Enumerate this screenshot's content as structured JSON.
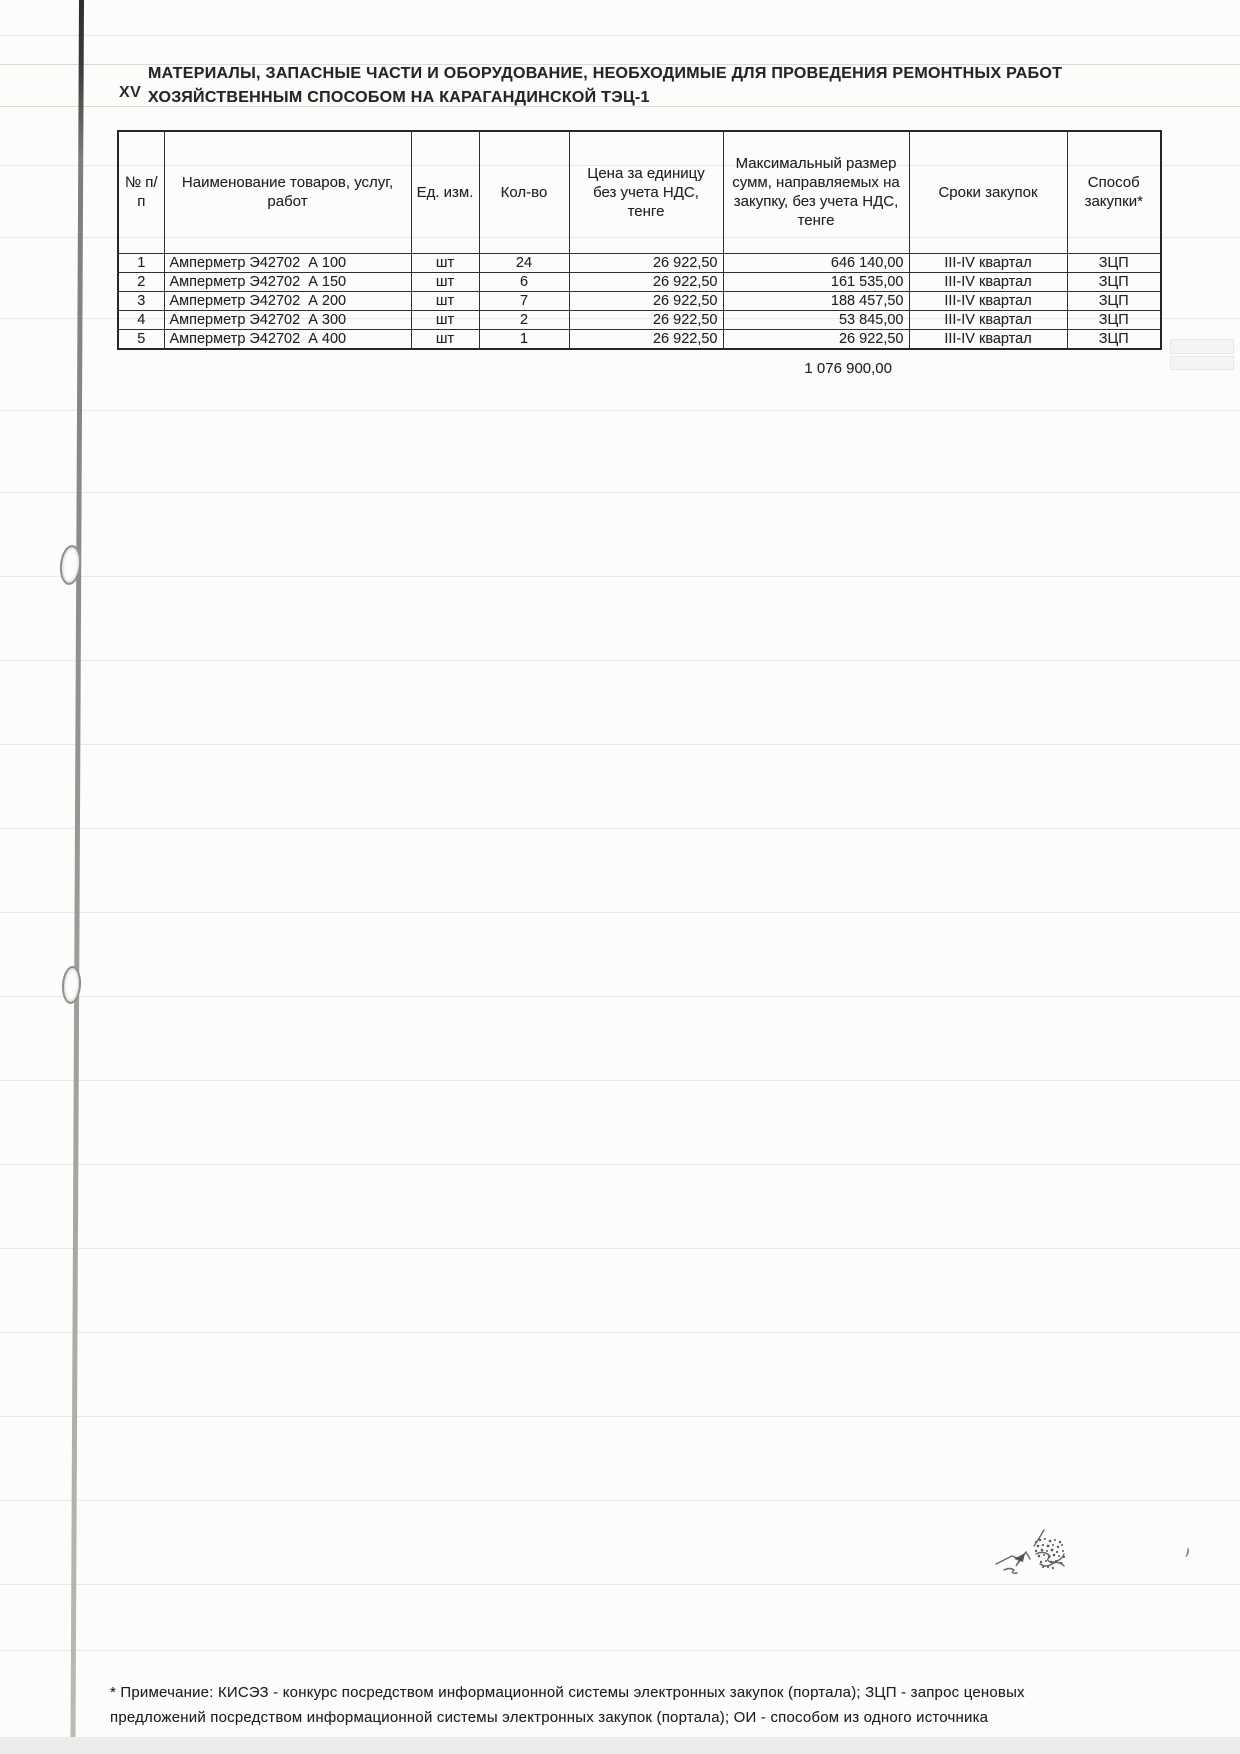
{
  "page": {
    "section_number": "XV",
    "title_line1": "МАТЕРИАЛЫ, ЗАПАСНЫЕ ЧАСТИ И ОБОРУДОВАНИЕ, НЕОБХОДИМЫЕ ДЛЯ ПРОВЕДЕНИЯ РЕМОНТНЫХ РАБОТ",
    "title_line2": "ХОЗЯЙСТВЕННЫМ СПОСОБОМ НА КАРАГАНДИНСКОЙ ТЭЦ-1"
  },
  "table": {
    "headers": [
      "№ п/п",
      "Наименование товаров, услуг, работ",
      "Ед. изм.",
      "Кол-во",
      "Цена за единицу без учета НДС, тенге",
      "Максимальный размер сумм, направляемых на закупку, без учета НДС, тенге",
      "Сроки закупок",
      "Способ закупки*"
    ],
    "rows": [
      {
        "num": "1",
        "name": "Амперметр Э42702  А 100",
        "unit": "шт",
        "qty": "24",
        "price": "26 922,50",
        "sum": "646 140,00",
        "period": "III-IV квартал",
        "method": "ЗЦП"
      },
      {
        "num": "2",
        "name": "Амперметр Э42702  А 150",
        "unit": "шт",
        "qty": "6",
        "price": "26 922,50",
        "sum": "161 535,00",
        "period": "III-IV квартал",
        "method": "ЗЦП"
      },
      {
        "num": "3",
        "name": "Амперметр Э42702  А 200",
        "unit": "шт",
        "qty": "7",
        "price": "26 922,50",
        "sum": "188 457,50",
        "period": "III-IV квартал",
        "method": "ЗЦП"
      },
      {
        "num": "4",
        "name": "Амперметр Э42702  А 300",
        "unit": "шт",
        "qty": "2",
        "price": "26 922,50",
        "sum": "53 845,00",
        "period": "III-IV квартал",
        "method": "ЗЦП"
      },
      {
        "num": "5",
        "name": "Амперметр Э42702  А 400",
        "unit": "шт",
        "qty": "1",
        "price": "26 922,50",
        "sum": "26 922,50",
        "period": "III-IV квартал",
        "method": "ЗЦП"
      }
    ],
    "total": "1 076 900,00"
  },
  "footnote": {
    "line1": "* Примечание: КИСЭЗ - конкурс посредством информационной системы электронных закупок (портала); ЗЦП - запрос ценовых",
    "line2": "предложений посредством информационной системы электронных закупок (портала); ОИ - способом из одного источника"
  }
}
